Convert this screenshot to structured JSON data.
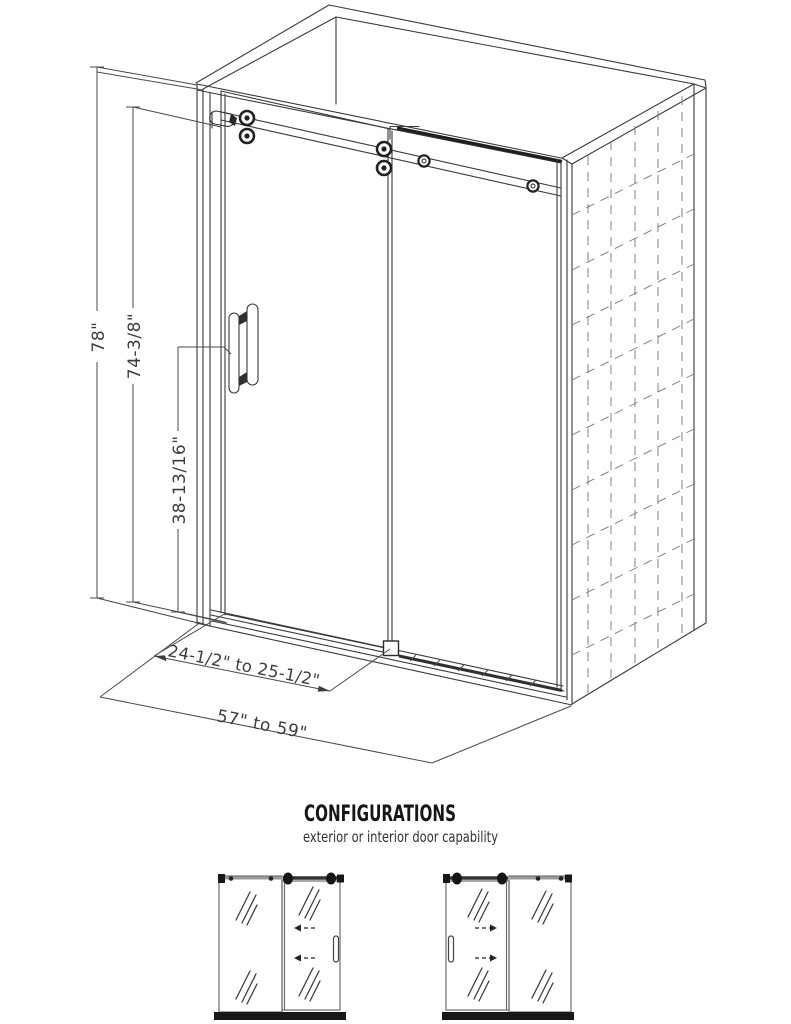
{
  "drawing": {
    "dim_total_height": "78\"",
    "dim_glass_height": "74-3/8\"",
    "dim_handle_height": "38-13/16\"",
    "dim_door_width": "24-1/2\" to 25-1/2\"",
    "dim_overall_width": "57\" to 59\""
  },
  "configurations": {
    "title": "CONFIGURATIONS",
    "subtitle": "exterior or interior door capability"
  },
  "colors": {
    "line": "#3a3a3a",
    "dark": "#181818",
    "tile_dash": "#7d7d7d",
    "dim_text": "#3d3d3d"
  }
}
